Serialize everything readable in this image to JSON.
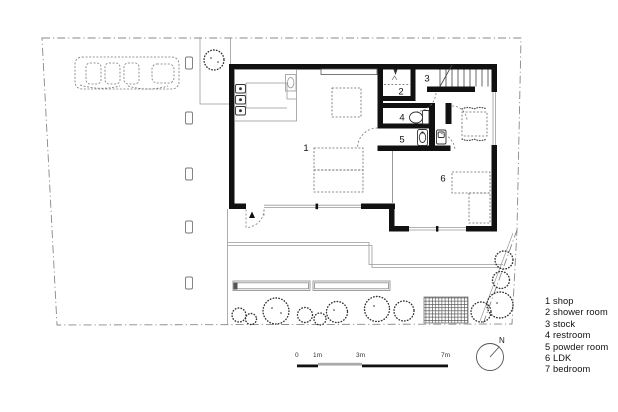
{
  "title": "house floor plan with site",
  "colors": {
    "wall": "#111111",
    "thin_line": "#999999",
    "dashed_line": "#777777",
    "boundary": "#888888",
    "scale_mid_segment": "#aaaaaa"
  },
  "plan_labels": {
    "shop": "1",
    "shower_room": "2",
    "stock": "3",
    "restroom": "4",
    "powder_room": "5",
    "ldk": "6"
  },
  "legend": {
    "items": [
      "1 shop",
      "2 shower room",
      "3 stock",
      "4 restroom",
      "5 powder room",
      "6 LDK",
      "7 bedroom"
    ]
  },
  "scale_bar": {
    "labels": [
      "0",
      "1m",
      "3m",
      "7m"
    ]
  },
  "north_arrow": {
    "label": "N"
  }
}
